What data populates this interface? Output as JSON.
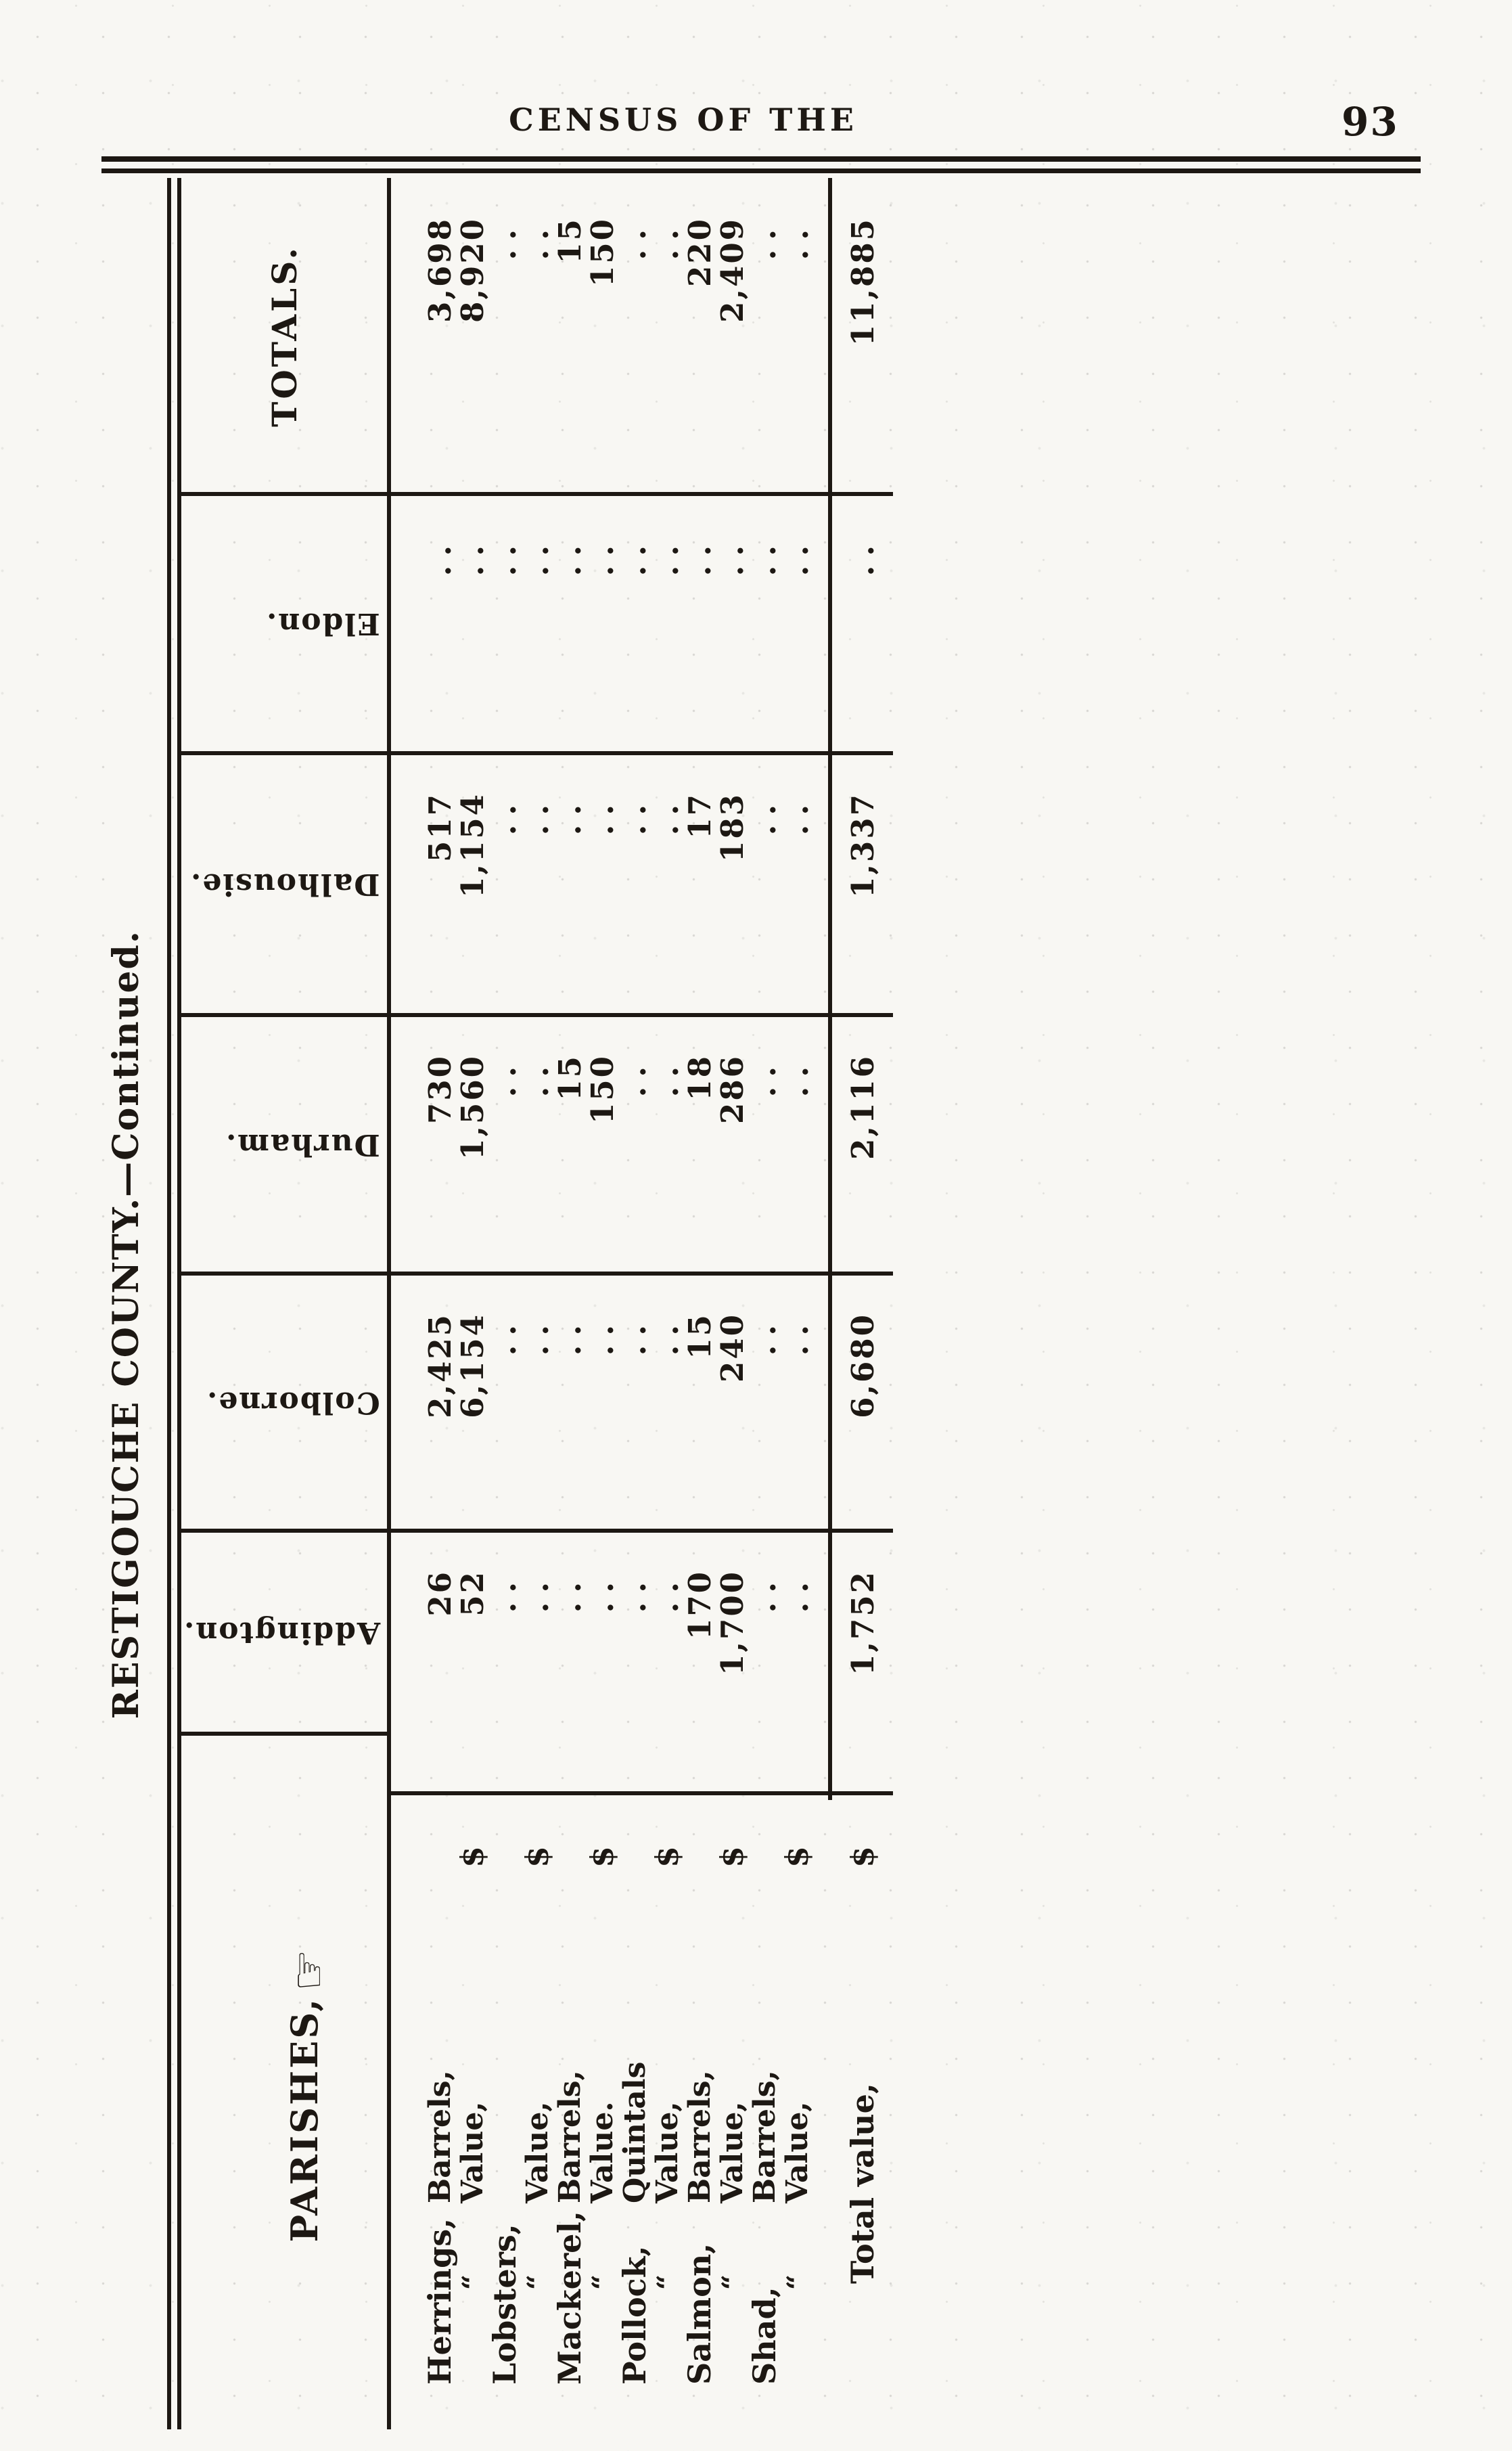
{
  "page": {
    "running_header": "CENSUS OF THE",
    "page_number": "93",
    "side_title": "RESTIGOUCHE COUNTY.—Continued."
  },
  "table": {
    "parishes_label": "PARISHES,",
    "pointing_hand": "☞",
    "columns": [
      "Addington.",
      "Colborne.",
      "Durham.",
      "Dalhousie.",
      "Eldon.",
      "TOTALS."
    ],
    "rows": [
      {
        "name": "Herrings,",
        "sub": "Barrels,",
        "dollar": "",
        "values": [
          "26",
          "2,425",
          "730",
          "517",
          "..",
          "3,698"
        ]
      },
      {
        "name": "“",
        "sub": "Value,",
        "dollar": "$",
        "values": [
          "52",
          "6,154",
          "1,560",
          "1,154",
          "..",
          "8,920"
        ]
      },
      {
        "name": "Lobsters,",
        "sub": "",
        "dollar": "",
        "values": [
          "..",
          "..",
          "..",
          "..",
          "..",
          ".."
        ]
      },
      {
        "name": "“",
        "sub": "Value,",
        "dollar": "$",
        "values": [
          "..",
          "..",
          "..",
          "..",
          "..",
          ".."
        ]
      },
      {
        "name": "Mackerel,",
        "sub": "Barrels,",
        "dollar": "",
        "values": [
          "..",
          "..",
          "15",
          "..",
          "..",
          "15"
        ]
      },
      {
        "name": "“",
        "sub": "Value.",
        "dollar": "$",
        "values": [
          "..",
          "..",
          "150",
          "..",
          "..",
          "150"
        ]
      },
      {
        "name": "Pollock,",
        "sub": "Quintals",
        "dollar": "",
        "values": [
          "..",
          "..",
          "..",
          "..",
          "..",
          ".."
        ]
      },
      {
        "name": "“",
        "sub": "Value,",
        "dollar": "$",
        "values": [
          "..",
          "..",
          "..",
          "..",
          "..",
          ".."
        ]
      },
      {
        "name": "Salmon,",
        "sub": "Barrels,",
        "dollar": "",
        "values": [
          "170",
          "15",
          "18",
          "17",
          "..",
          "220"
        ]
      },
      {
        "name": "“",
        "sub": "Value,",
        "dollar": "$",
        "values": [
          "1,700",
          "240",
          "286",
          "183",
          "..",
          "2,409"
        ]
      },
      {
        "name": "Shad,",
        "sub": "Barrels,",
        "dollar": "",
        "values": [
          "..",
          "..",
          "..",
          "..",
          "..",
          ".."
        ]
      },
      {
        "name": "“",
        "sub": "Value,",
        "dollar": "$",
        "values": [
          "..",
          "..",
          "..",
          "..",
          "..",
          ".."
        ]
      }
    ],
    "total_row": {
      "label": "Total value,",
      "dollar": "$",
      "values": [
        "1,752",
        "6,680",
        "2,116",
        "1,337",
        "..",
        "11,885"
      ]
    }
  }
}
